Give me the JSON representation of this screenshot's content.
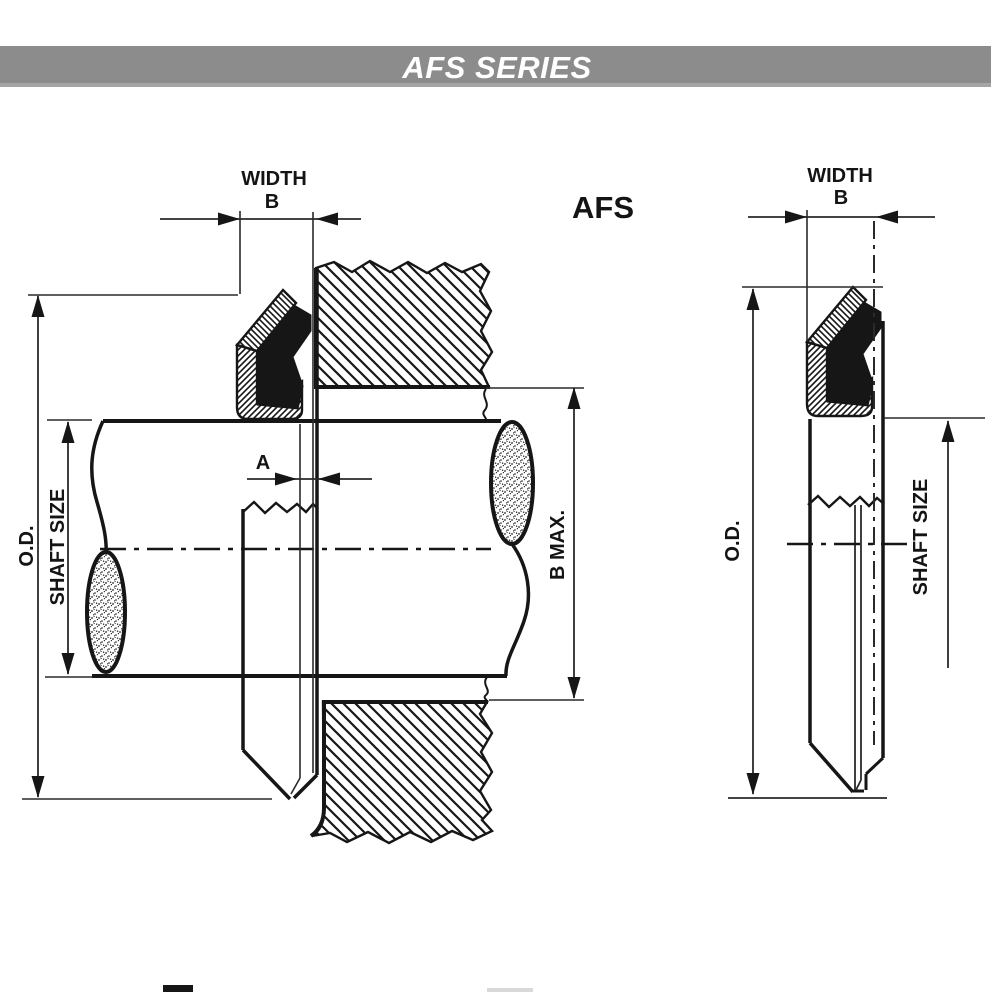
{
  "banner": {
    "title": "AFS SERIES"
  },
  "views": {
    "title": "AFS",
    "left": {
      "width_label": "WIDTH",
      "width_value": "B",
      "a_label": "A",
      "b_max_label": "B MAX.",
      "od_label": "O.D.",
      "shaft_size_label": "SHAFT SIZE"
    },
    "right": {
      "width_label": "WIDTH",
      "width_value": "B",
      "od_label": "O.D.",
      "shaft_size_label": "SHAFT SIZE"
    }
  },
  "colors": {
    "banner_bg": "#8c8c8c",
    "banner_bg_edge": "#a5a5a5",
    "banner_text": "#ffffff",
    "line": "#161616",
    "dim_line": "#2a2a2a",
    "background": "#ffffff"
  }
}
